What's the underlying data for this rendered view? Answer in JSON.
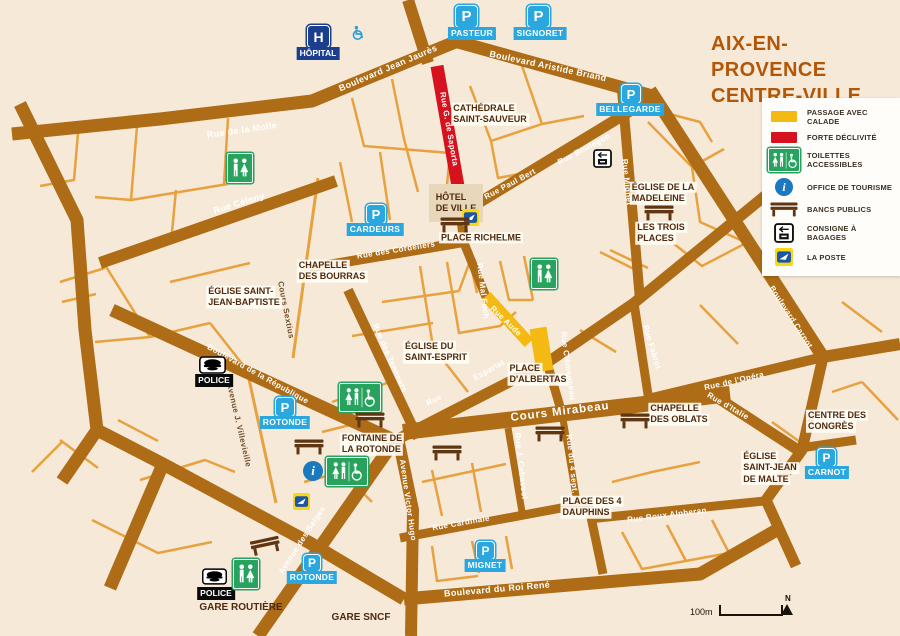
{
  "title": {
    "line1": "AIX-EN-PROVENCE",
    "line2": "CENTRE-VILLE"
  },
  "legend": {
    "passage": {
      "label": "PASSAGE AVEC CALADE",
      "color": "#f4b913"
    },
    "declivite": {
      "label": "FORTE DÉCLIVITÉ",
      "color": "#d5121e"
    },
    "toilettes": {
      "label": "TOILETTES ACCESSIBLES",
      "color": "#27a35d"
    },
    "office": {
      "label": "OFFICE DE TOURISME",
      "color": "#1b79c0"
    },
    "bancs": {
      "label": "BANCS PUBLICS",
      "color": "#5f3512"
    },
    "consigne": {
      "label": "CONSIGNE À BAGAGES"
    },
    "laposte": {
      "label": "LA POSTE",
      "color": "#f9d616"
    }
  },
  "parkings": {
    "glyph": "P",
    "pasteur": "PASTEUR",
    "signoret": "SIGNORET",
    "bellegarde": "BELLEGARDE",
    "cardeurs": "CARDEURS",
    "rotonde_nord": "ROTONDE",
    "rotonde_sud": "ROTONDE",
    "mignet": "MIGNET",
    "carnot": "CARNOT"
  },
  "markers": {
    "h_glyph": "H",
    "i_glyph": "i",
    "hopital": "HÔPITAL",
    "police_nord": "POLICE",
    "police_sud": "POLICE"
  },
  "places": {
    "cathedrale": {
      "lines": [
        "CATHÉDRALE",
        "SAINT-SAUVEUR"
      ]
    },
    "hotel_de_ville": {
      "lines": [
        "HÔTEL",
        "DE VILLE"
      ]
    },
    "richelme": {
      "lines": [
        "PLACE RICHELME"
      ]
    },
    "madeleine": {
      "lines": [
        "ÉGLISE DE LA",
        "MADELEINE"
      ]
    },
    "trois_places": {
      "lines": [
        "LES TROIS",
        "PLACES"
      ]
    },
    "bourras": {
      "lines": [
        "CHAPELLE",
        "DES BOURRAS"
      ]
    },
    "saint_jean_baptiste": {
      "lines": [
        "ÉGLISE SAINT-",
        "JEAN-BAPTISTE"
      ]
    },
    "saint_esprit": {
      "lines": [
        "ÉGLISE DU",
        "SAINT-ESPRIT"
      ]
    },
    "albertas": {
      "lines": [
        "PLACE",
        "D'ALBERTAS"
      ]
    },
    "oblats": {
      "lines": [
        "CHAPELLE",
        "DES OBLATS"
      ]
    },
    "congres": {
      "lines": [
        "CENTRE DES",
        "CONGRÈS"
      ]
    },
    "malte": {
      "lines": [
        "ÉGLISE",
        "SAINT-JEAN",
        "DE MALTE"
      ]
    },
    "dauphins": {
      "lines": [
        "PLACE DES 4",
        "DAUPHINS"
      ]
    },
    "fontaine": {
      "lines": [
        "FONTAINE DE",
        "LA ROTONDE"
      ]
    },
    "gare_routiere": {
      "lines": [
        "GARE ROUTIÈRE"
      ]
    },
    "gare_sncf": {
      "lines": [
        "GARE SNCF"
      ]
    }
  },
  "streets": {
    "molle": "Rue de la Molle",
    "jaures": "Boulevard Jean Jaurès",
    "briand": "Boulevard Aristide Briand",
    "celony": "Rue Célony",
    "saporta": "Rue G. de Saporta",
    "paul_bert": "Rue Paul Bert",
    "boulegon": "Rue Boulegon",
    "mignet": "Rue Mignet",
    "carnot": "Boulevard Carnot",
    "cordeliers": "Rue des Cordeliers",
    "foch": "Rue Mal Foch",
    "tanneurs": "Rue des Tanneurs",
    "republique": "Boulevard de la République",
    "aude": "Rue Aude",
    "espariat": "Espariat",
    "espariat_rue": "Rue",
    "clemenceau": "Rue Clémenceau",
    "fabrot": "Rue Fabrot",
    "opera": "Rue de l'Opéra",
    "italie": "Rue d'Italie",
    "mirabeau": "Cours Mirabeau",
    "cabassol": "Rue J. Cabassol",
    "quatre_sept": "Rue du 4 sept.",
    "victor_hugo": "Avenue Victor Hugo",
    "cardinale": "Rue Cardinale",
    "roux_alpheran": "Rue Roux Alpheran",
    "roi_rene": "Boulevard du Roi René",
    "belges": "Avenue des Belges",
    "sextius": "Cours Sextius",
    "villevieille": "Avenue J. Villevieille"
  },
  "scale": {
    "distance": "100m",
    "north": "N"
  },
  "colors": {
    "background": "#f6e9d8",
    "road_major": "#ad6c15",
    "road_minor": "#e7a23f",
    "calade": "#f4b913",
    "declivite": "#d5121e",
    "parking_blue": "#2aa7df",
    "hospital_navy": "#1c3e8e",
    "toilets_green": "#27a35d",
    "title_orange": "#b25708"
  }
}
